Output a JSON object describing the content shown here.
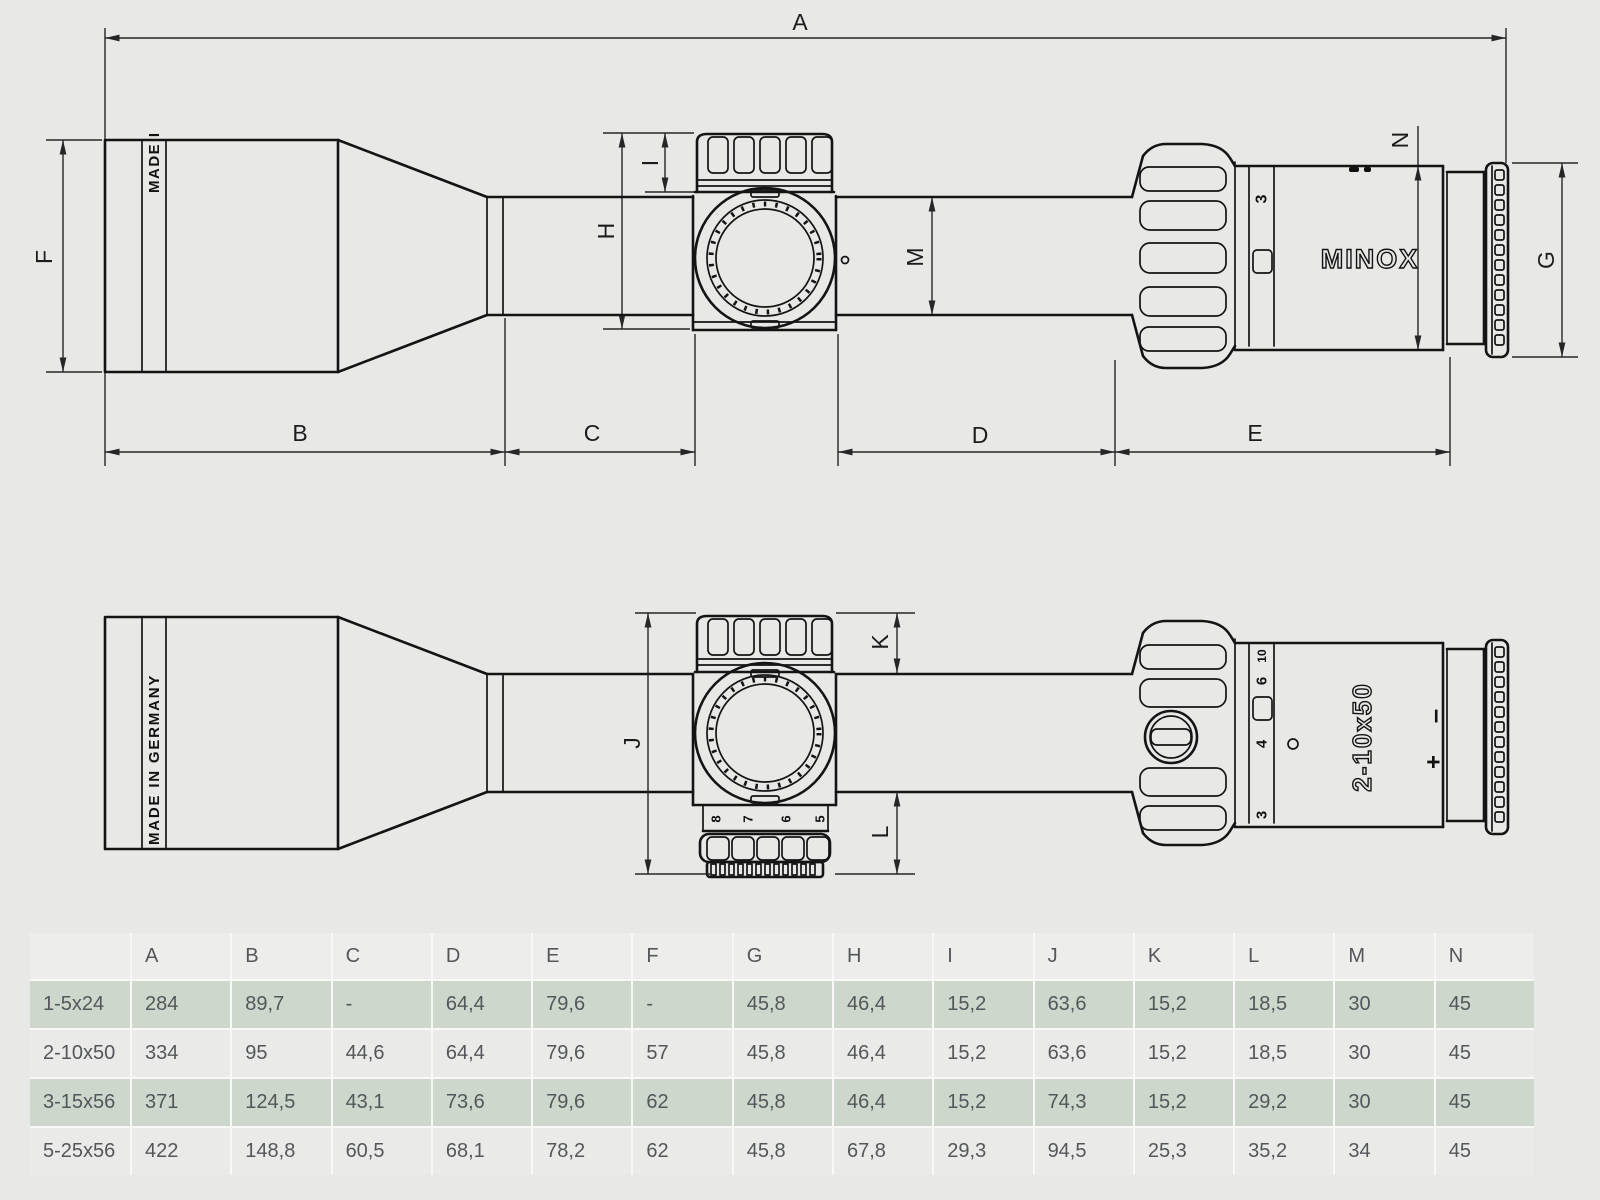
{
  "diagram": {
    "brand_logo": "MINOX",
    "made_in_full": "MADE IN GERMANY",
    "made_in_partial": "MADE I",
    "model_marking": "2-10x50",
    "diopter_plus": "+",
    "diopter_minus": "–",
    "dim_labels": {
      "A": "A",
      "B": "B",
      "C": "C",
      "D": "D",
      "E": "E",
      "F": "F",
      "G": "G",
      "H": "H",
      "I": "I",
      "J": "J",
      "K": "K",
      "L": "L",
      "M": "M",
      "N": "N"
    },
    "mag_ring_numbers_top_view": [
      "3"
    ],
    "mag_ring_numbers_front_view": [
      "10",
      "6",
      "4",
      "3"
    ],
    "illumination_numbers": [
      "8",
      "7",
      "6",
      "5"
    ]
  },
  "table": {
    "corner": "",
    "headers": [
      "A",
      "B",
      "C",
      "D",
      "E",
      "F",
      "G",
      "H",
      "I",
      "J",
      "K",
      "L",
      "M",
      "N"
    ],
    "rows": [
      {
        "model": "1-5x24",
        "values": [
          "284",
          "89,7",
          "-",
          "64,4",
          "79,6",
          "-",
          "45,8",
          "46,4",
          "15,2",
          "63,6",
          "15,2",
          "18,5",
          "30",
          "45"
        ]
      },
      {
        "model": "2-10x50",
        "values": [
          "334",
          "95",
          "44,6",
          "64,4",
          "79,6",
          "57",
          "45,8",
          "46,4",
          "15,2",
          "63,6",
          "15,2",
          "18,5",
          "30",
          "45"
        ]
      },
      {
        "model": "3-15x56",
        "values": [
          "371",
          "124,5",
          "43,1",
          "73,6",
          "79,6",
          "62",
          "45,8",
          "46,4",
          "15,2",
          "74,3",
          "15,2",
          "29,2",
          "30",
          "45"
        ]
      },
      {
        "model": "5-25x56",
        "values": [
          "422",
          "148,8",
          "60,5",
          "68,1",
          "78,2",
          "62",
          "45,8",
          "67,8",
          "29,3",
          "94,5",
          "25,3",
          "35,2",
          "34",
          "45"
        ]
      }
    ]
  },
  "colors": {
    "background": "#e8e8e7",
    "line": "#141414",
    "row_green": "#cdd7cb",
    "row_light": "#eaeae8",
    "header": "#ededeb",
    "text": "#54575a"
  }
}
